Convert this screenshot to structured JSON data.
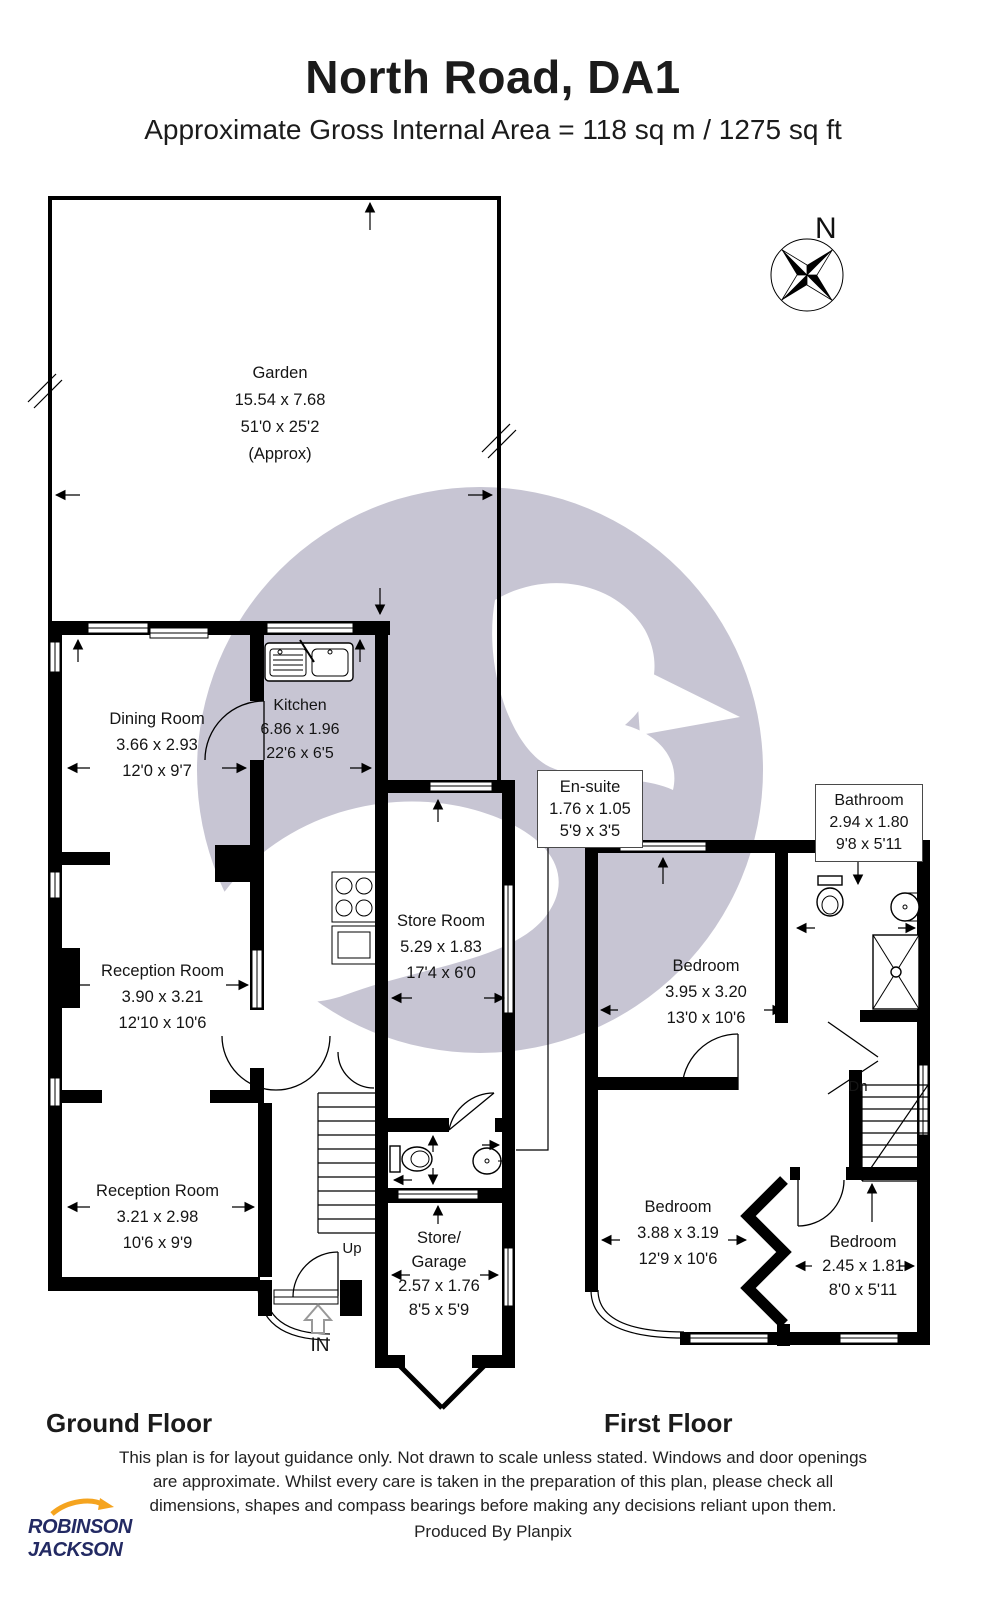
{
  "header": {
    "title": "North Road, DA1",
    "subtitle": "Approximate Gross Internal Area = 118 sq m / 1275 sq ft"
  },
  "compass": {
    "label": "N"
  },
  "garden": {
    "name": "Garden",
    "metric": "15.54 x 7.68",
    "imperial": "51'0 x 25'2",
    "note": "(Approx)"
  },
  "ground_floor": {
    "label": "Ground Floor",
    "stairs_label": "Up",
    "entrance_label": "IN",
    "rooms": {
      "dining": {
        "name": "Dining Room",
        "metric": "3.66 x 2.93",
        "imperial": "12'0 x 9'7"
      },
      "kitchen": {
        "name": "Kitchen",
        "metric": "6.86 x 1.96",
        "imperial": "22'6 x 6'5"
      },
      "reception1": {
        "name": "Reception Room",
        "metric": "3.90 x 3.21",
        "imperial": "12'10 x 10'6"
      },
      "reception2": {
        "name": "Reception Room",
        "metric": "3.21 x 2.98",
        "imperial": "10'6 x 9'9"
      },
      "store": {
        "name": "Store Room",
        "metric": "5.29 x 1.83",
        "imperial": "17'4 x 6'0"
      },
      "garage": {
        "name1": "Store/",
        "name2": "Garage",
        "metric": "2.57 x 1.76",
        "imperial": "8'5 x 5'9"
      },
      "ensuite": {
        "name": "En-suite",
        "metric": "1.76 x 1.05",
        "imperial": "5'9 x 3'5"
      }
    }
  },
  "first_floor": {
    "label": "First Floor",
    "stairs_label": "Dn",
    "rooms": {
      "bathroom": {
        "name": "Bathroom",
        "metric": "2.94 x 1.80",
        "imperial": "9'8 x 5'11"
      },
      "bedroom1": {
        "name": "Bedroom",
        "metric": "3.95 x 3.20",
        "imperial": "13'0 x 10'6"
      },
      "bedroom2": {
        "name": "Bedroom",
        "metric": "3.88 x 3.19",
        "imperial": "12'9 x 10'6"
      },
      "bedroom3": {
        "name": "Bedroom",
        "metric": "2.45 x 1.81",
        "imperial": "8'0 x 5'11"
      }
    }
  },
  "footer": {
    "disclaimer_line1": "This plan is for layout guidance only. Not drawn to scale unless stated. Windows and door openings",
    "disclaimer_line2": "are approximate. Whilst every care is taken in the preparation of this plan, please check all",
    "disclaimer_line3": "dimensions, shapes and compass bearings before making any decisions reliant upon them.",
    "produced_by": "Produced By Planpix",
    "agent_line1": "ROBINSON",
    "agent_line2": "JACKSON"
  },
  "colors": {
    "watermark": "#c7c5d3",
    "wall": "#000000",
    "logo_navy": "#232a63",
    "logo_orange": "#f5a41f"
  }
}
